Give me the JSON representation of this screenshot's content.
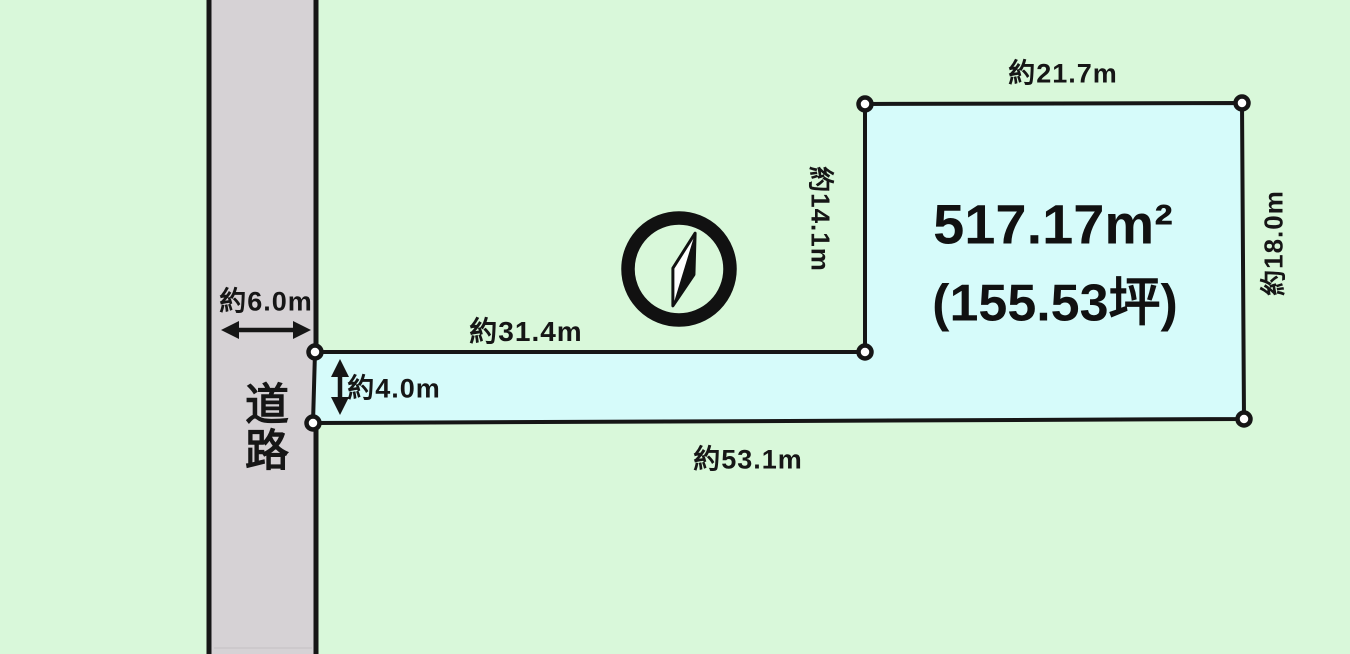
{
  "diagram_title": "land-plot-diagram",
  "colors": {
    "background": "#d9f8da",
    "parcel_fill": "#d6fbfa",
    "road_fill": "#d6d2d5",
    "line": "#161616",
    "vertex_fill": "#ffffff"
  },
  "road": {
    "name_label": "道路",
    "width_label": "約6.0m"
  },
  "parcel": {
    "area_label": "517.17m²",
    "area_tsubo_label": "(155.53坪)",
    "edge_labels": {
      "pole_top": "約31.4m",
      "pole_width": "約4.0m",
      "bottom": "約53.1m",
      "main_top": "約21.7m",
      "main_left": "約14.1m",
      "main_right": "約18.0m"
    }
  },
  "icons": {
    "compass": "compass-north-needle-icon"
  }
}
